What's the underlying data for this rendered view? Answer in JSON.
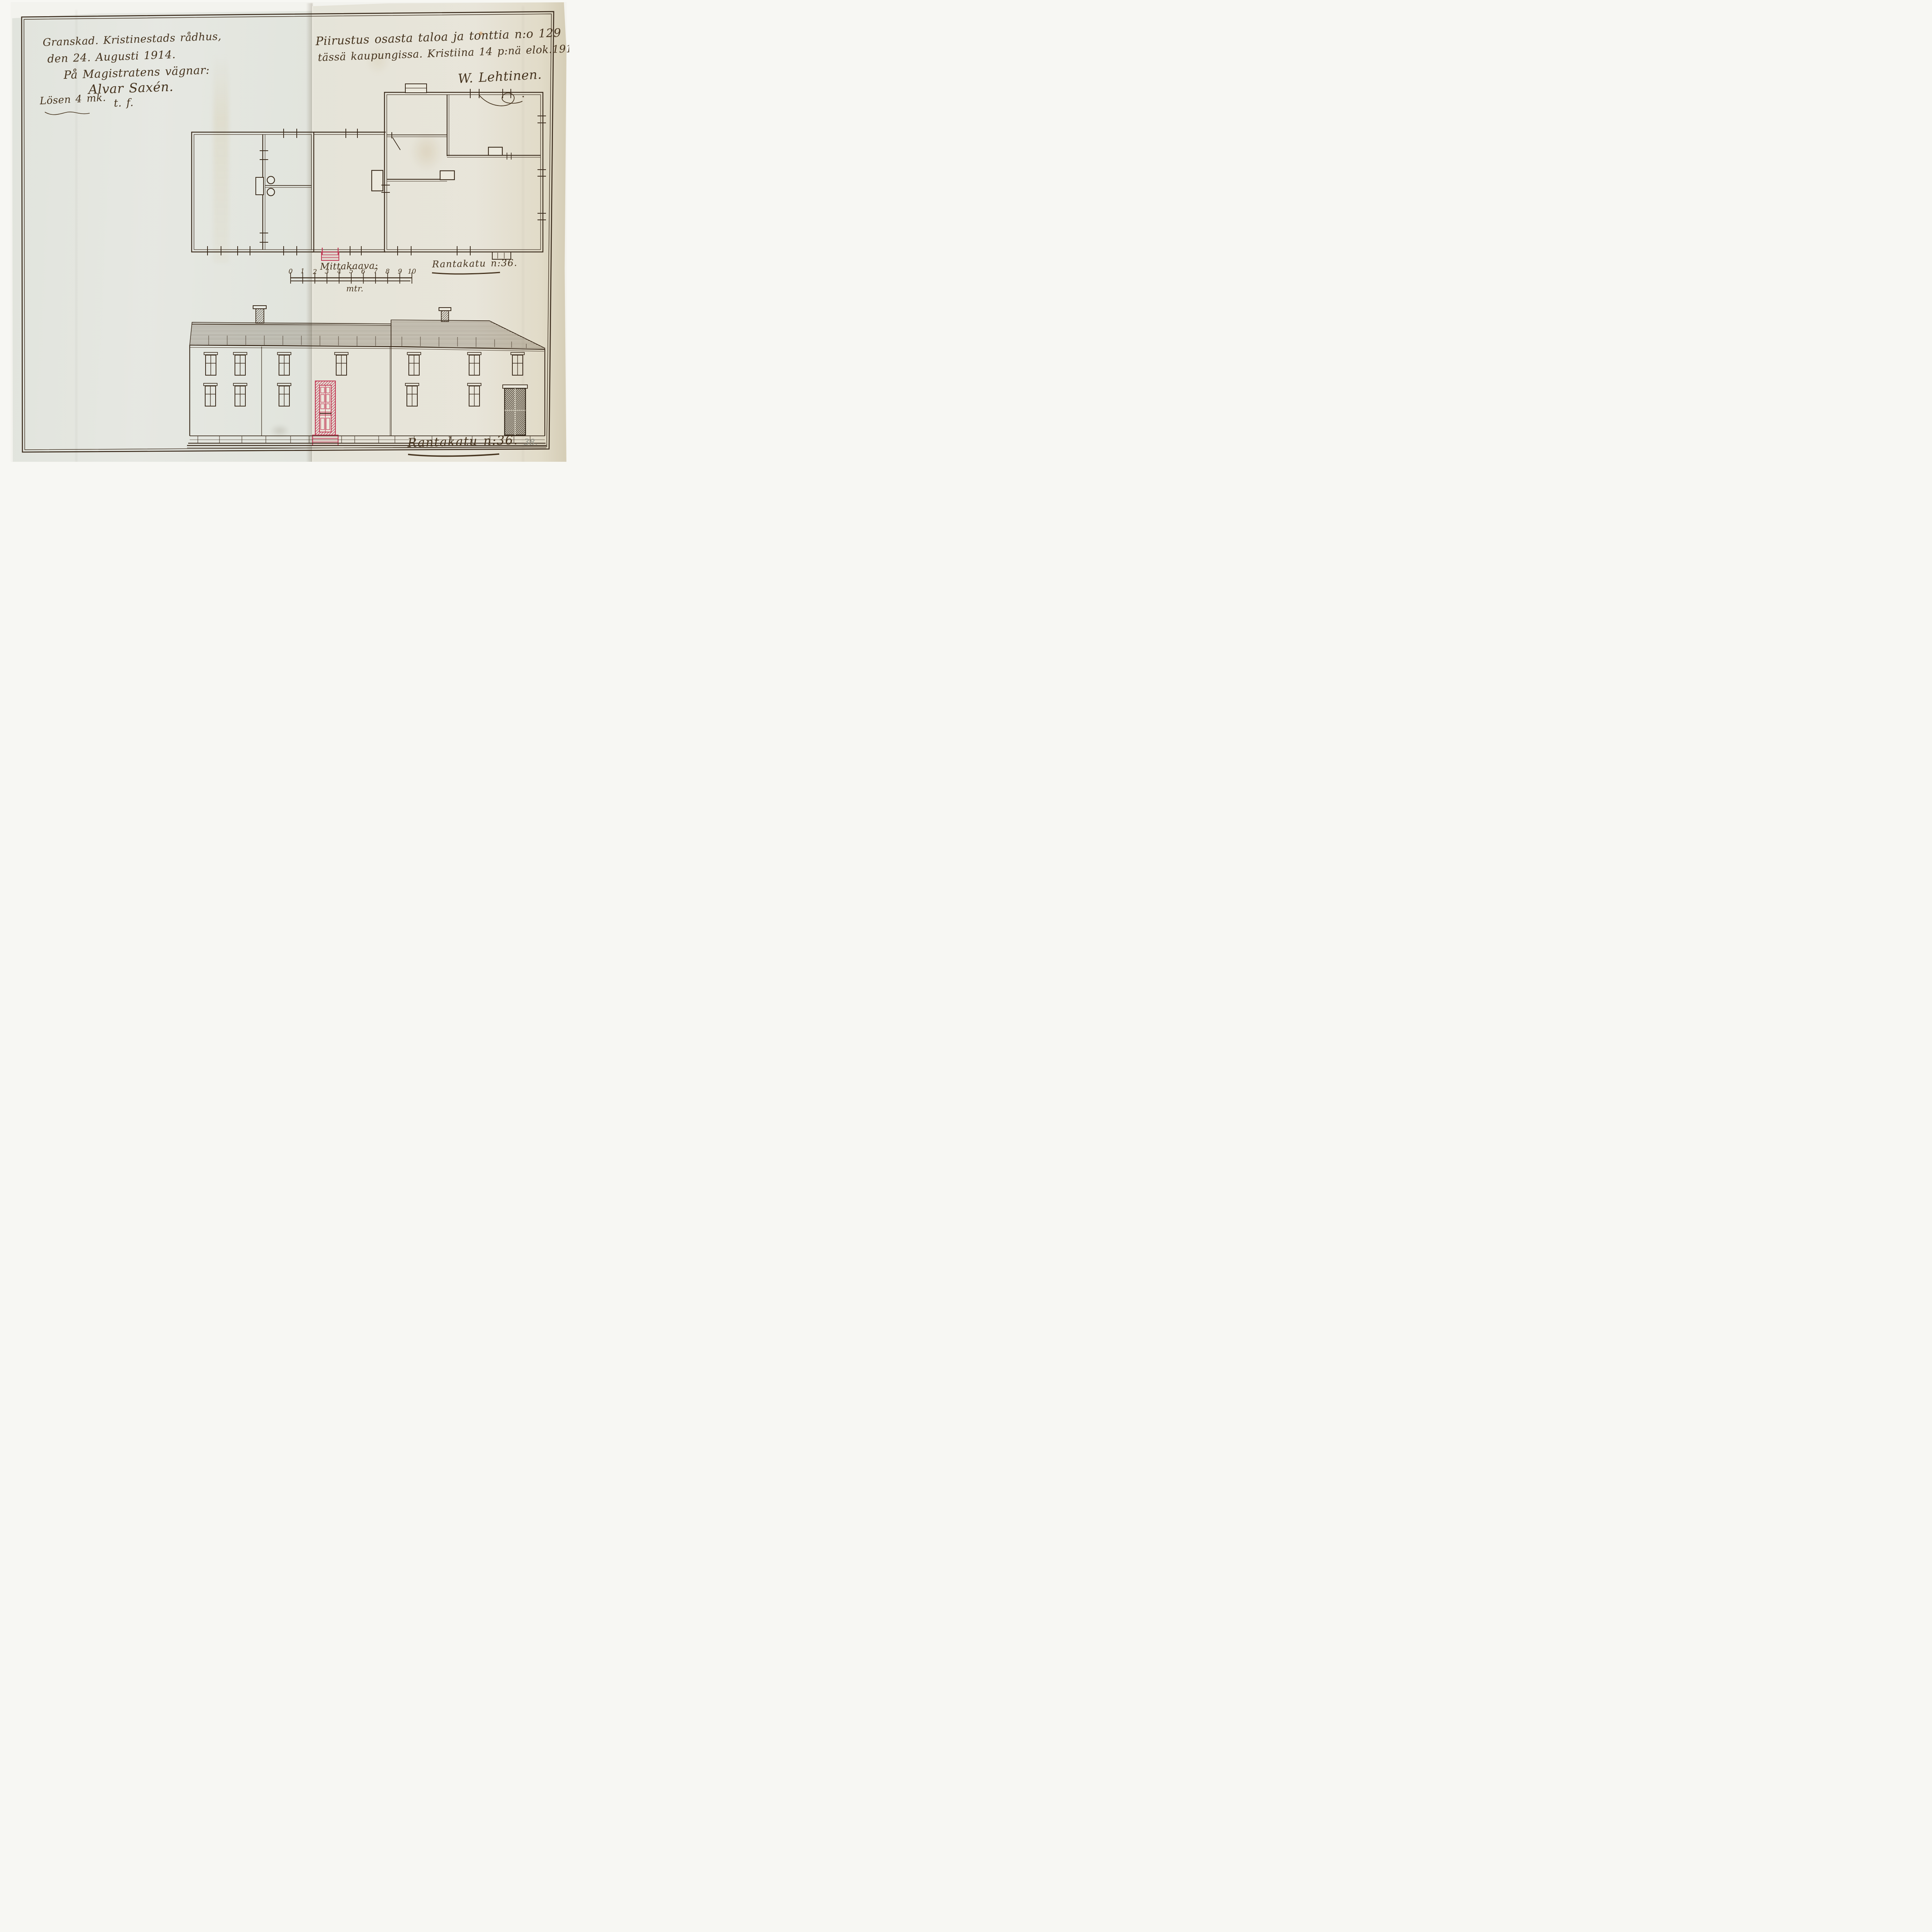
{
  "annotations": {
    "review_note": {
      "lines": [
        "Granskad. Kristinestads rådhus,",
        "den 24. Augusti 1914.",
        "På Magistratens vägnar:"
      ],
      "signature": "Alvar Saxén.",
      "signature_suffix": "t. f.",
      "fee_note": "Lösen 4 mk."
    },
    "title_note": {
      "line1": "Piirustus osasta taloa ja tonttia n:o 129",
      "line2": "tässä kaupungissa. Kristiina 14 p:nä elok.1914.",
      "signature": "W. Lehtinen."
    },
    "street_label_plan": "Rantakatu n:36.",
    "street_label_elevation": "Rantakatu n:36.",
    "page_number_pencil": "38."
  },
  "scale_bar": {
    "title": "Mittakaava:",
    "unit": "mtr.",
    "tick_labels": [
      "0",
      "1",
      "2",
      "3",
      "4",
      "5",
      "6",
      "7",
      "8",
      "9",
      "10"
    ]
  },
  "colors": {
    "ink": "#3a2b1c",
    "accent_red": "#c23a56",
    "pencil": "#8e9086",
    "paper_left": "#e8ebe4",
    "paper_right": "#eae7da"
  }
}
